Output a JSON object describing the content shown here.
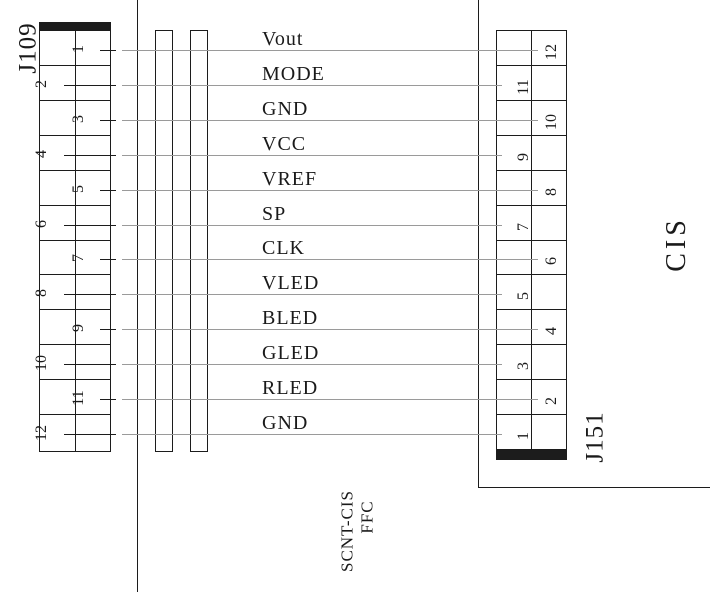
{
  "diagram": {
    "left_connector": {
      "label": "J109"
    },
    "right_connector": {
      "label": "J151"
    },
    "module": {
      "label": "CIS"
    },
    "cable": {
      "line1": "SCNT-CIS",
      "line2": "FFC"
    },
    "signals": [
      {
        "name": "Vout",
        "left_pin": "1",
        "right_pin": "12"
      },
      {
        "name": "MODE",
        "left_pin": "2",
        "right_pin": "11"
      },
      {
        "name": "GND",
        "left_pin": "3",
        "right_pin": "10"
      },
      {
        "name": "VCC",
        "left_pin": "4",
        "right_pin": "9"
      },
      {
        "name": "VREF",
        "left_pin": "5",
        "right_pin": "8"
      },
      {
        "name": "SP",
        "left_pin": "6",
        "right_pin": "7"
      },
      {
        "name": "CLK",
        "left_pin": "7",
        "right_pin": "6"
      },
      {
        "name": "VLED",
        "left_pin": "8",
        "right_pin": "5"
      },
      {
        "name": "BLED",
        "left_pin": "9",
        "right_pin": "4"
      },
      {
        "name": "GLED",
        "left_pin": "10",
        "right_pin": "3"
      },
      {
        "name": "RLED",
        "left_pin": "11",
        "right_pin": "2"
      },
      {
        "name": "GND",
        "left_pin": "12",
        "right_pin": "1"
      }
    ]
  },
  "colors": {
    "line": "#1c1c1c",
    "wire": "#9a9a9a",
    "text": "#1a1a1a",
    "background": "#ffffff"
  }
}
